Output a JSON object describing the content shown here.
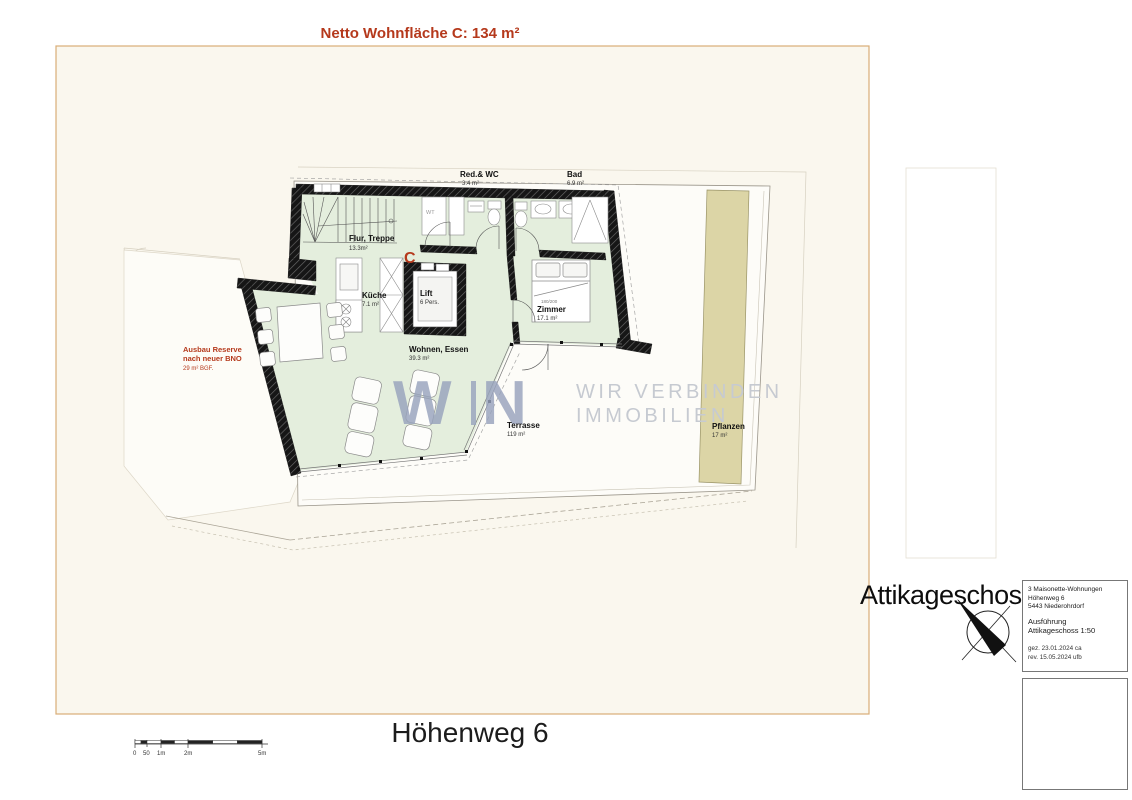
{
  "colors": {
    "accent_red": "#b5391c",
    "room_green": "#e4eedd",
    "plant_beige": "#dcd5a6",
    "watermark_blue": "#98a3bd",
    "watermark_gray": "#c6cad1",
    "sheet_border": "#d9ad77"
  },
  "header": {
    "net_area_label": "Netto Wohnfläche C: 134 m²"
  },
  "plan": {
    "unit_letter": "C",
    "rooms": {
      "red_wc": {
        "name": "Red.& WC",
        "area": "3.4 m²"
      },
      "bad": {
        "name": "Bad",
        "area": "6.9 m²"
      },
      "flur": {
        "name": "Flur, Treppe",
        "area": "13.3m²"
      },
      "kueche": {
        "name": "Küche",
        "area": "7.1 m²"
      },
      "lift": {
        "name": "Lift",
        "capacity": "6 Pers."
      },
      "zimmer": {
        "name": "Zimmer",
        "area": "17.1 m²",
        "bed_size": "180/200"
      },
      "wohnen": {
        "name": "Wohnen, Essen",
        "area": "39.3 m²"
      },
      "terrasse": {
        "name": "Terrasse",
        "area": "119 m²"
      },
      "pflanzen": {
        "name": "Pflanzen",
        "area": "17 m²"
      }
    },
    "annotations": {
      "ausbau_line1": "Ausbau Reserve",
      "ausbau_line2": "nach neuer BNO",
      "ausbau_line3": "29 m² BGF.",
      "wt": "WT"
    }
  },
  "watermark": {
    "logo_w": "W",
    "logo_n": "N",
    "tag1": "WIR VERBINDEN",
    "tag2": "IMMOBILIEN"
  },
  "title_block": {
    "floor_title": "Attikageschoss",
    "project_line1": "3 Maisonette-Wohnungen",
    "project_line2": "Höhenweg 6",
    "project_line3": "5443 Niederohrdorf",
    "phase": "Ausführung",
    "sheet": "Attikageschoss 1:50",
    "drawn": "gez.  23.01.2024 ca",
    "revised": "rev.   15.05.2024 ufb"
  },
  "footer": {
    "street_title": "Höhenweg 6",
    "scale_labels": [
      "0",
      "50",
      "1m",
      "2m",
      "5m"
    ]
  }
}
